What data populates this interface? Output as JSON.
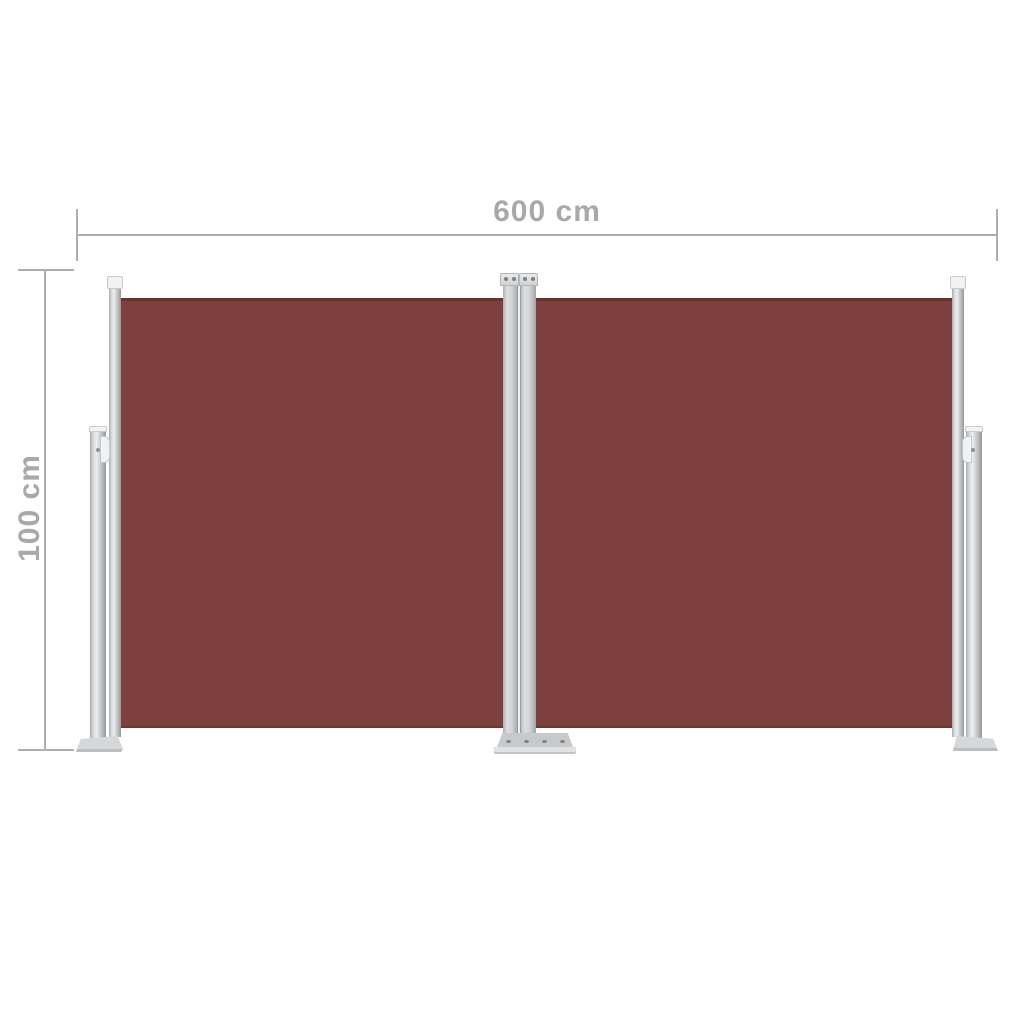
{
  "image": {
    "type": "product-photo-with-dimension-annotations",
    "subject": "Retractable double side awning, brown fabric, grey metal posts",
    "background_color": "#ffffff"
  },
  "annotations": {
    "width_label": "600 cm",
    "height_label": "100 cm"
  },
  "colors": {
    "background": "#ffffff",
    "fabric": "#7e403d",
    "dim_line": "#aeaeae",
    "dim_text": "#a9a9a9",
    "cap_white": "#f1f2f3",
    "plate": "#d5d7d8",
    "plate_front": "#e0e2e3",
    "screw": "#7f8183"
  }
}
